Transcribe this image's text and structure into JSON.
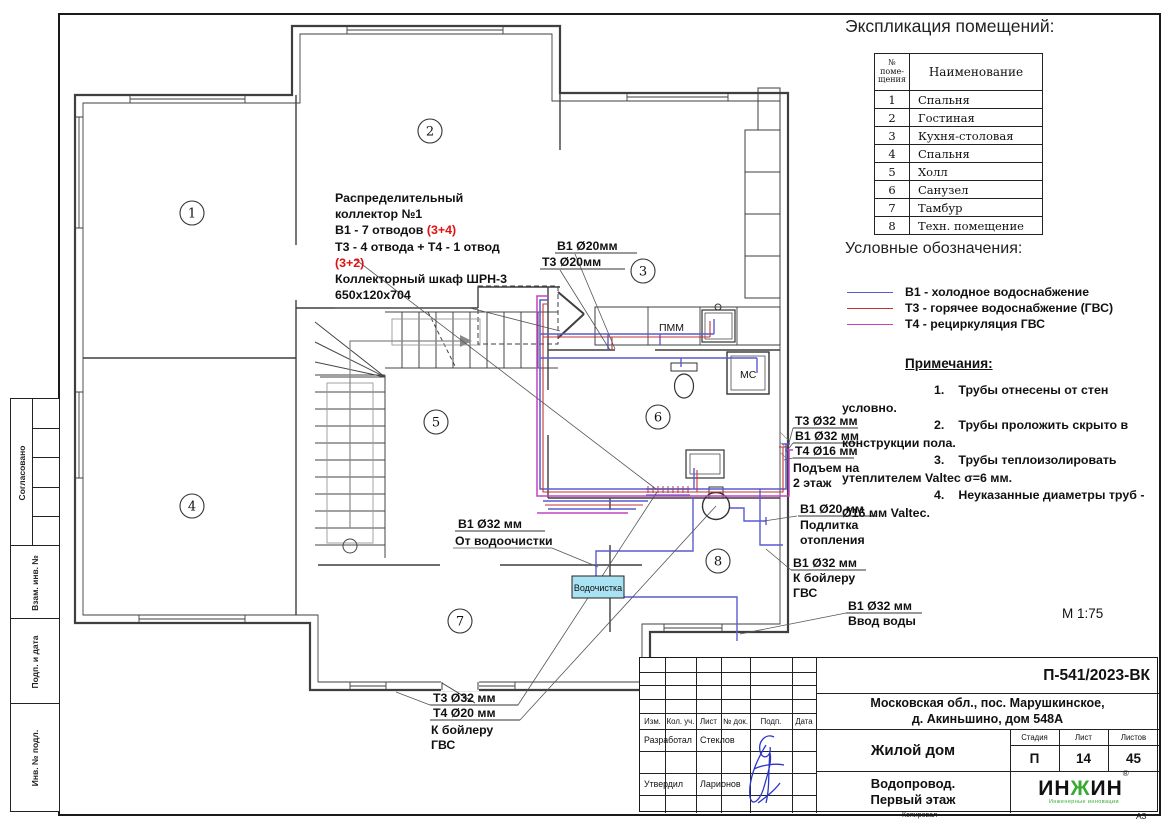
{
  "sheet": {
    "scale": "М 1:75",
    "copied_label": "Копировал",
    "format_label": "А3"
  },
  "side_stamp": {
    "agreed": "Согласовано",
    "rows": [
      "Взам. инв. №",
      "Подп. и дата",
      "Инв. № подл."
    ]
  },
  "explication": {
    "title": "Экспликация помещений:",
    "col_num_header": "№\nпоме-\nщения",
    "col_name_header": "Наименование",
    "rows": [
      {
        "num": "1",
        "name": "Спальня"
      },
      {
        "num": "2",
        "name": "Гостиная"
      },
      {
        "num": "3",
        "name": "Кухня-столовая"
      },
      {
        "num": "4",
        "name": "Спальня"
      },
      {
        "num": "5",
        "name": "Холл"
      },
      {
        "num": "6",
        "name": "Санузел"
      },
      {
        "num": "7",
        "name": "Тамбур"
      },
      {
        "num": "8",
        "name": "Техн. помещение"
      }
    ]
  },
  "legend": {
    "title": "Условные обозначения:",
    "items": [
      {
        "label": "В1 - холодное водоснабжение",
        "color": "#5a5ad2"
      },
      {
        "label": "Т3 - горячее водоснабжение (ГВС)",
        "color": "#c23434"
      },
      {
        "label": "Т4 - рециркуляция ГВС",
        "color": "#c243c2"
      }
    ]
  },
  "notes": {
    "title": "Примечания:",
    "items": [
      {
        "num": "1.",
        "text": "Трубы отнесены от стен условно."
      },
      {
        "num": "2.",
        "text": "Трубы проложить скрыто в конструкции пола."
      },
      {
        "num": "3.",
        "text": "Трубы теплоизолировать утеплителем Valtec σ=6 мм."
      },
      {
        "num": "4.",
        "text": "Неуказанные диаметры труб - Ø16 мм Valtec."
      }
    ]
  },
  "plan": {
    "room_numbers": [
      "1",
      "2",
      "3",
      "4",
      "5",
      "6",
      "7",
      "8"
    ],
    "collector_note": {
      "line1": "Распределительный",
      "line2": "коллектор №1",
      "line3a": "В1 - 7 отводов ",
      "line3b": "(3+4)",
      "line4": "Т3 - 4 отвода + Т4 - 1 отвод",
      "line5": "(3+2)",
      "line6": "Коллекторный шкаф ШРН-3",
      "line7": "650х120х704"
    },
    "labels": {
      "kitchen_b1": "В1 Ø20мм",
      "kitchen_t3": "Т3 Ø20мм",
      "riser_t3": "Т3 Ø32 мм",
      "riser_b1": "В1 Ø32 мм",
      "riser_t4": "Т4 Ø16 мм",
      "riser_text1": "Подъем на",
      "riser_text2": "2 этаж",
      "makeup_b1": "В1 Ø20 мм",
      "makeup_text1": "Подлитка",
      "makeup_text2": "отопления",
      "boiler_b1": "В1 Ø32 мм",
      "boiler_text1": "К бойлеру",
      "boiler_text2": "ГВС",
      "inlet_b1": "В1 Ø32 мм",
      "inlet_text": "Ввод воды",
      "filter_b1": "В1 Ø32 мм",
      "filter_text": "От водоочистки",
      "hot_t3": "Т3 Ø32 мм",
      "hot_t4": "Т4 Ø20 мм",
      "hot_text1": "К бойлеру",
      "hot_text2": "ГВС",
      "dishwasher": "ПММ",
      "washer": "МС",
      "water_box": "Водочистка"
    }
  },
  "title_block": {
    "doc_number": "П-541/2023-ВК",
    "address1": "Московская обл., пос. Марушкинское,",
    "address2": "д. Акиньшино, дом 548А",
    "object_name": "Жилой дом",
    "drawing_name1": "Водопровод.",
    "drawing_name2": "Первый этаж",
    "stage_label": "Стадия",
    "sheet_label": "Лист",
    "sheets_label": "Листов",
    "stage": "П",
    "sheet_num": "14",
    "sheets_total": "45",
    "columns": [
      "Изм.",
      "Кол. уч.",
      "Лист",
      "№ док.",
      "Подп.",
      "Дата"
    ],
    "role1": "Разработал",
    "name1": "Стеклов",
    "role2": "Утвердил",
    "name2": "Ларионов",
    "logo_a": "ИН",
    "logo_b": "Ж",
    "logo_c": "ИН",
    "logo_reg": "®",
    "logo_sub": "Инженерные инновации"
  },
  "colors": {
    "b1": "#5a5ad2",
    "t3": "#c23434",
    "t4": "#c243c2",
    "water_box_fill": "#a9e2f2",
    "logo_green": "#3aaa35",
    "signature": "#2a35c8"
  }
}
